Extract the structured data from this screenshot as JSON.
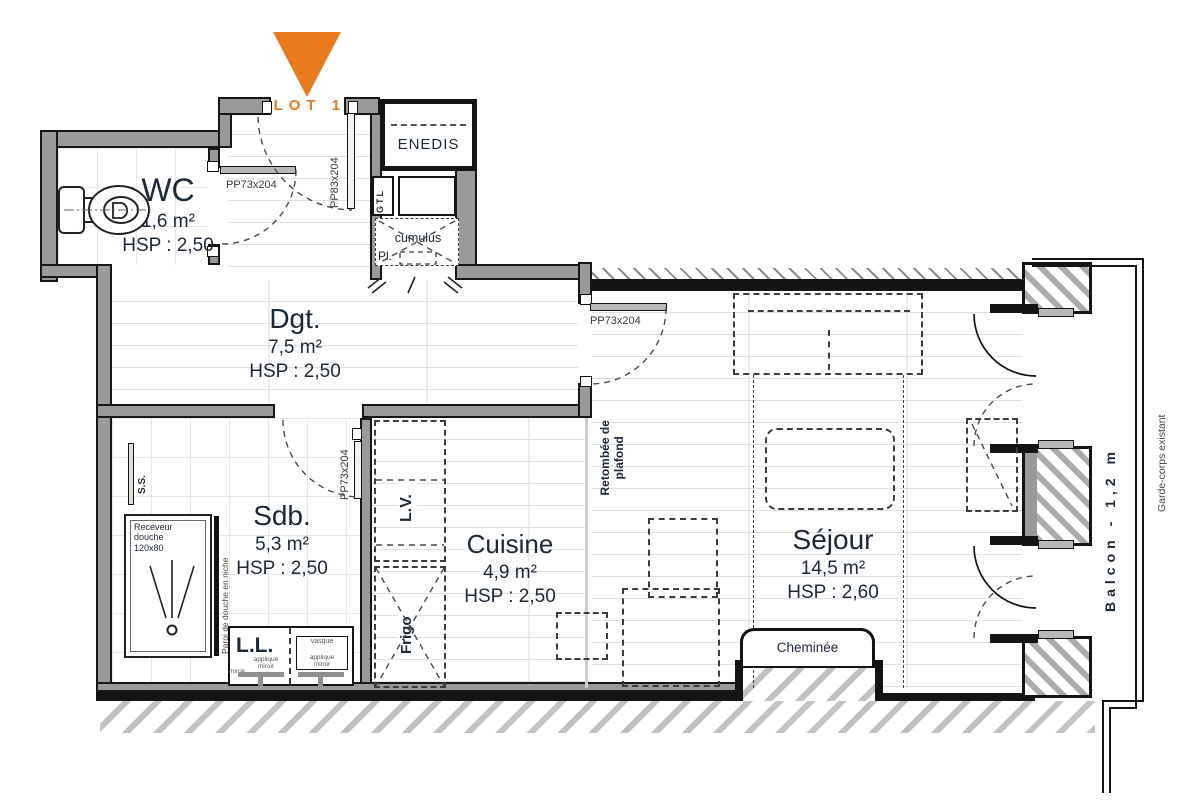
{
  "accent_orange": "#E8791D",
  "lot": {
    "label": "LOT 13"
  },
  "rooms": {
    "wc": {
      "name": "WC",
      "area": "1,6 m²",
      "hsp": "HSP : 2,50"
    },
    "dgt": {
      "name": "Dgt.",
      "area": "7,5 m²",
      "hsp": "HSP : 2,50"
    },
    "sdb": {
      "name": "Sdb.",
      "area": "5,3 m²",
      "hsp": "HSP : 2,50"
    },
    "cuisine": {
      "name": "Cuisine",
      "area": "4,9 m²",
      "hsp": "HSP : 2,50"
    },
    "sejour": {
      "name": "Séjour",
      "area": "14,5 m²",
      "hsp": "HSP : 2,60"
    }
  },
  "doors": {
    "entry": "PP83x204",
    "wc": "PP73x204",
    "sejour": "PP73x204",
    "sdb": "PP73x204"
  },
  "closets": {
    "enedis": "ENEDIS",
    "gtl": "GTL",
    "cumulus": "cumulus",
    "placard": "Pl."
  },
  "bathroom": {
    "towel_dryer": "S.S.",
    "shower_tray": "Receveur\ndouche\n120x80",
    "shower_wall": "Paroi de douche en niche",
    "washing_machine": "L.L.",
    "mirror_light_left": "applique\nmiroir",
    "mirror_light_right": "applique\nmiroir",
    "mirror": "miroir",
    "basin": "vasque"
  },
  "kitchen": {
    "dishwasher": "L.V.",
    "fridge": "Frigo"
  },
  "living": {
    "ceiling_drop": "Retombée de\nplafond",
    "fireplace": "Cheminée"
  },
  "balcony": {
    "label": "Balcon - 1,2 m",
    "railing": "Garde-corps existant"
  }
}
